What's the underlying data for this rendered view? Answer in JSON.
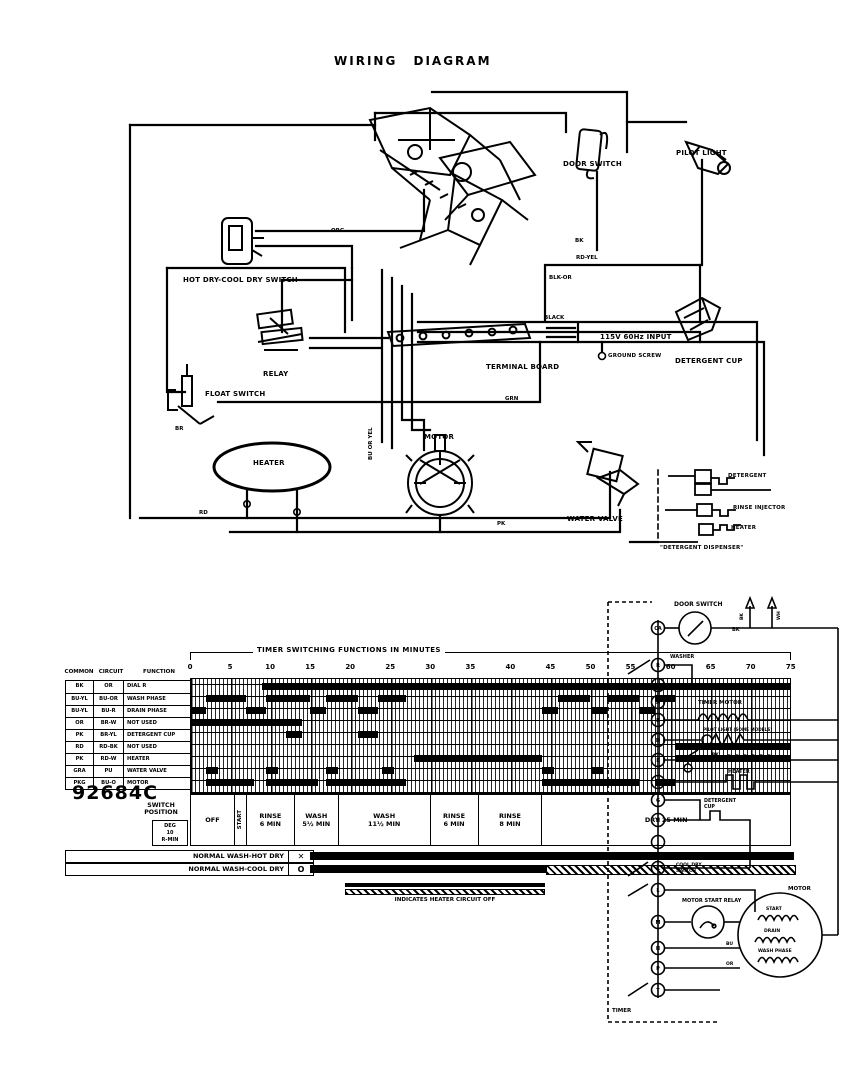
{
  "title": "WIRING DIAGRAM",
  "pictorial": {
    "components": {
      "door_switch": "DOOR SWITCH",
      "pilot_light": "PILOT LIGHT",
      "hot_dry_switch": "HOT DRY-COOL DRY SWITCH",
      "relay": "RELAY",
      "terminal_board": "TERMINAL BOARD",
      "input": "115V 60Hz INPUT",
      "ground_screw": "GROUND SCREW",
      "detergent_cup": "DETERGENT CUP",
      "float_switch": "FLOAT SWITCH",
      "heater": "HEATER",
      "motor": "MOTOR",
      "water_valve": "WATER VALVE"
    },
    "inset": {
      "items": [
        "DETERGENT",
        "RINSE INJECTOR",
        "HEATER"
      ],
      "caption": "\"DETERGENT DISPENSER\""
    },
    "wire_labels": [
      "ORG",
      "BK",
      "RD-YEL",
      "BLK-OR",
      "BLACK",
      "GRN",
      "BR",
      "RD",
      "PK",
      "BU OR YEL"
    ]
  },
  "timer_chart": {
    "header_title": "TIMER SWITCHING FUNCTIONS IN MINUTES",
    "axis": {
      "start": 0,
      "end": 75,
      "step": 5,
      "ticks": [
        0,
        5,
        10,
        15,
        20,
        25,
        30,
        35,
        40,
        45,
        50,
        55,
        60,
        65,
        70,
        75
      ]
    },
    "columns": [
      "COMMON",
      "CIRCUIT",
      "FUNCTION"
    ],
    "rows": [
      {
        "common": "BK",
        "circuit": "OR",
        "function": "DIAL R",
        "segments": [
          [
            9,
            75
          ]
        ]
      },
      {
        "common": "BU-YL",
        "circuit": "BU-OR",
        "function": "WASH PHASE",
        "segments": [
          [
            2,
            7
          ],
          [
            9.5,
            15
          ],
          [
            17,
            21
          ],
          [
            23.5,
            27
          ],
          [
            46,
            50
          ],
          [
            52,
            56
          ],
          [
            58,
            60.5
          ]
        ]
      },
      {
        "common": "BU-YL",
        "circuit": "BU-R",
        "function": "DRAIN PHASE",
        "segments": [
          [
            0,
            2
          ],
          [
            7,
            9.5
          ],
          [
            15,
            17
          ],
          [
            21,
            23.5
          ],
          [
            44,
            46
          ],
          [
            50,
            52
          ],
          [
            56,
            58
          ]
        ]
      },
      {
        "common": "OR",
        "circuit": "BR-W",
        "function": "NOT USED",
        "segments": [
          [
            0,
            14
          ]
        ]
      },
      {
        "common": "PK",
        "circuit": "BR-YL",
        "function": "DETERGENT CUP",
        "segments": [
          [
            12,
            14
          ],
          [
            21,
            23.5
          ]
        ]
      },
      {
        "common": "RD",
        "circuit": "RD-BK",
        "function": "NOT USED",
        "segments": [
          [
            60.5,
            75
          ]
        ]
      },
      {
        "common": "PK",
        "circuit": "RD-W",
        "function": "HEATER",
        "segments": [
          [
            28,
            44
          ],
          [
            60.5,
            75
          ]
        ]
      },
      {
        "common": "GRA",
        "circuit": "PU",
        "function": "WATER VALVE",
        "segments": [
          [
            2,
            3.5
          ],
          [
            9.5,
            11
          ],
          [
            17,
            18.5
          ],
          [
            24,
            25.5
          ],
          [
            44,
            45.5
          ],
          [
            50,
            51.5
          ]
        ]
      },
      {
        "common": "PKG",
        "circuit": "BU-O",
        "function": "MOTOR",
        "segments": [
          [
            2,
            8
          ],
          [
            9.5,
            16
          ],
          [
            17,
            27
          ],
          [
            44,
            56
          ],
          [
            58,
            60.5
          ]
        ]
      }
    ],
    "part_number": "92684C",
    "switch_position": {
      "l1": "SWITCH",
      "l2": "POSITION"
    },
    "sub_label": [
      "DEG",
      "10",
      "R-MIN"
    ],
    "phases": [
      {
        "l1": "OFF",
        "l2": "",
        "span": 5.5,
        "vert": false
      },
      {
        "l1": "START",
        "l2": "",
        "span": 1.5,
        "vert": true
      },
      {
        "l1": "RINSE",
        "l2": "6 MIN",
        "span": 6,
        "vert": false
      },
      {
        "l1": "WASH",
        "l2": "5½ MIN",
        "span": 5.5,
        "vert": false
      },
      {
        "l1": "WASH",
        "l2": "11½ MIN",
        "span": 11.5,
        "vert": false
      },
      {
        "l1": "RINSE",
        "l2": "6 MIN",
        "span": 6,
        "vert": false
      },
      {
        "l1": "RINSE",
        "l2": "8 MIN",
        "span": 8,
        "vert": false
      },
      {
        "l1": "DRY 25 MIN",
        "l2": "",
        "span": 31,
        "vert": false
      }
    ],
    "cycle_rows": [
      {
        "label": "NORMAL WASH-HOT DRY",
        "symbol": "✕",
        "solid": [
          15,
          75.4
        ],
        "hatched": null
      },
      {
        "label": "NORMAL WASH-COOL DRY",
        "symbol": "O",
        "solid": [
          15,
          44.5
        ],
        "hatched": [
          44.5,
          75.4
        ]
      }
    ],
    "legend_caption": "INDICATES HEATER CIRCUIT OFF"
  },
  "schematic": {
    "door_switch": "DOOR SWITCH",
    "washer_contact": "WASHER",
    "timer_motor": "TIMER MOTOR",
    "pilot_light": "PILOT LIGHT (SOME MODELS)",
    "float_switch": "FLOAT SWITCH",
    "water_valve": "WATER VALVE",
    "heater": "HEATER",
    "detergent_cup_1": "DETERGENT",
    "detergent_cup_2": "CUP",
    "hot_dry_1": "HOT DRY-",
    "hot_dry_2": "COOL DRY",
    "hot_dry_3": "SWITCH",
    "motor_start_relay": "MOTOR START RELAY",
    "motor": "MOTOR",
    "windings": [
      "START",
      "DRAIN",
      "WASH PHASE"
    ],
    "timer_label": "TIMER",
    "line_1": "BK",
    "line_2": "WH",
    "wire_bk": "BK",
    "wire_pk": "PK",
    "wire_bu": "BU",
    "wire_or": "OR",
    "terminals": [
      "CA",
      "R",
      "C",
      "A",
      "B",
      "D",
      "E",
      "F",
      "G",
      "H",
      "J",
      "K",
      "L",
      "M",
      "N",
      "P",
      "T"
    ]
  }
}
